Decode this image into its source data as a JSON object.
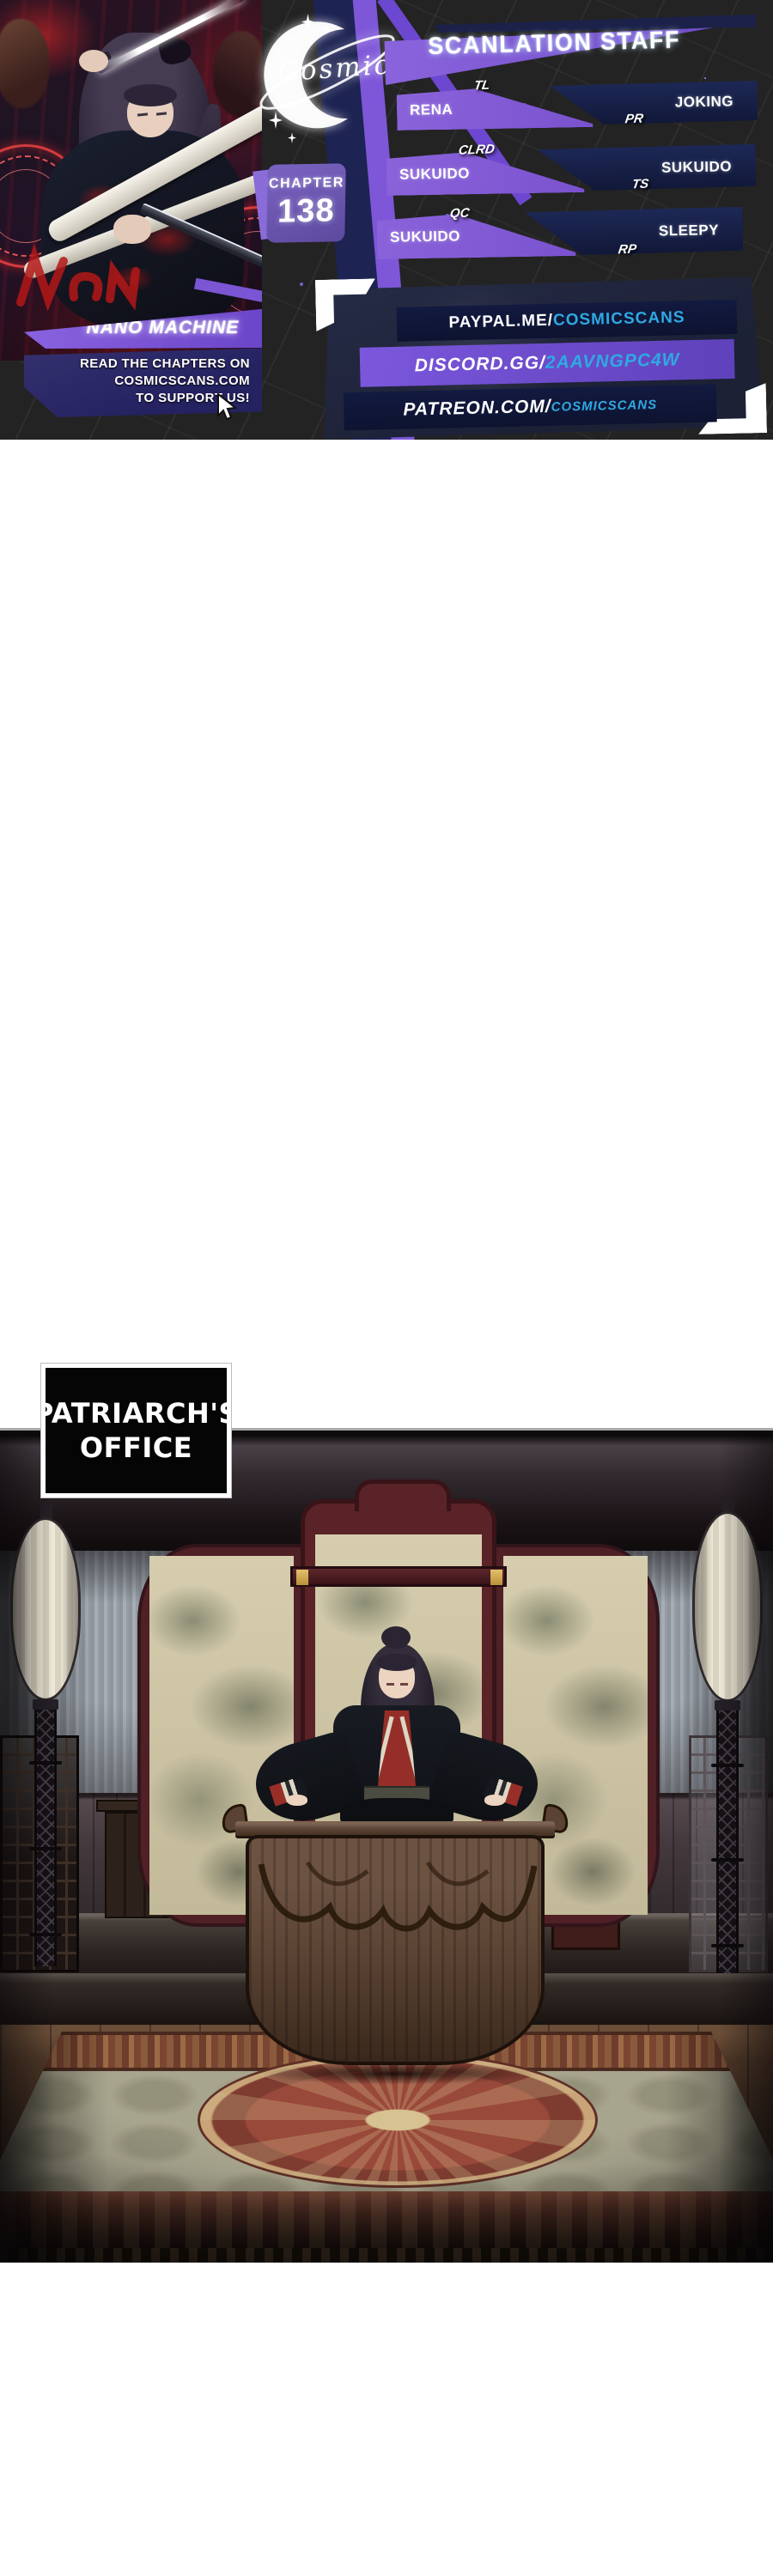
{
  "banner": {
    "logo_text": "Cosmic",
    "title": "SCANLATION STAFF",
    "chapter_label": "CHAPTER",
    "chapter_number": "138",
    "series_title": "NANO MACHINE",
    "promo_lines": [
      "READ THE CHAPTERS ON",
      "COSMICSCANS.COM",
      "TO SUPPORT US!"
    ],
    "staff": [
      {
        "role": "TL",
        "name": "RENA"
      },
      {
        "role": "PR",
        "name": "JOKING"
      },
      {
        "role": "CLRD",
        "name": "SUKUIDO"
      },
      {
        "role": "TS",
        "name": "SUKUIDO"
      },
      {
        "role": "QC",
        "name": "SUKUIDO"
      },
      {
        "role": "RP",
        "name": "SLEEPY"
      }
    ],
    "links": [
      {
        "prefix": "PAYPAL.ME/",
        "handle": "COSMICSCANS"
      },
      {
        "prefix": "DISCORD.GG/",
        "handle": "2AAVNGPC4W"
      },
      {
        "prefix": "PATREON.COM/",
        "handle": "COSMICSCANS"
      }
    ],
    "colors": {
      "purple": "#7e57d0",
      "navy": "#151d42",
      "cyan": "#2fa9e2",
      "background": "#232323"
    }
  },
  "panel": {
    "caption_line1": "PATRIARCH'S",
    "caption_line2": "OFFICE"
  }
}
